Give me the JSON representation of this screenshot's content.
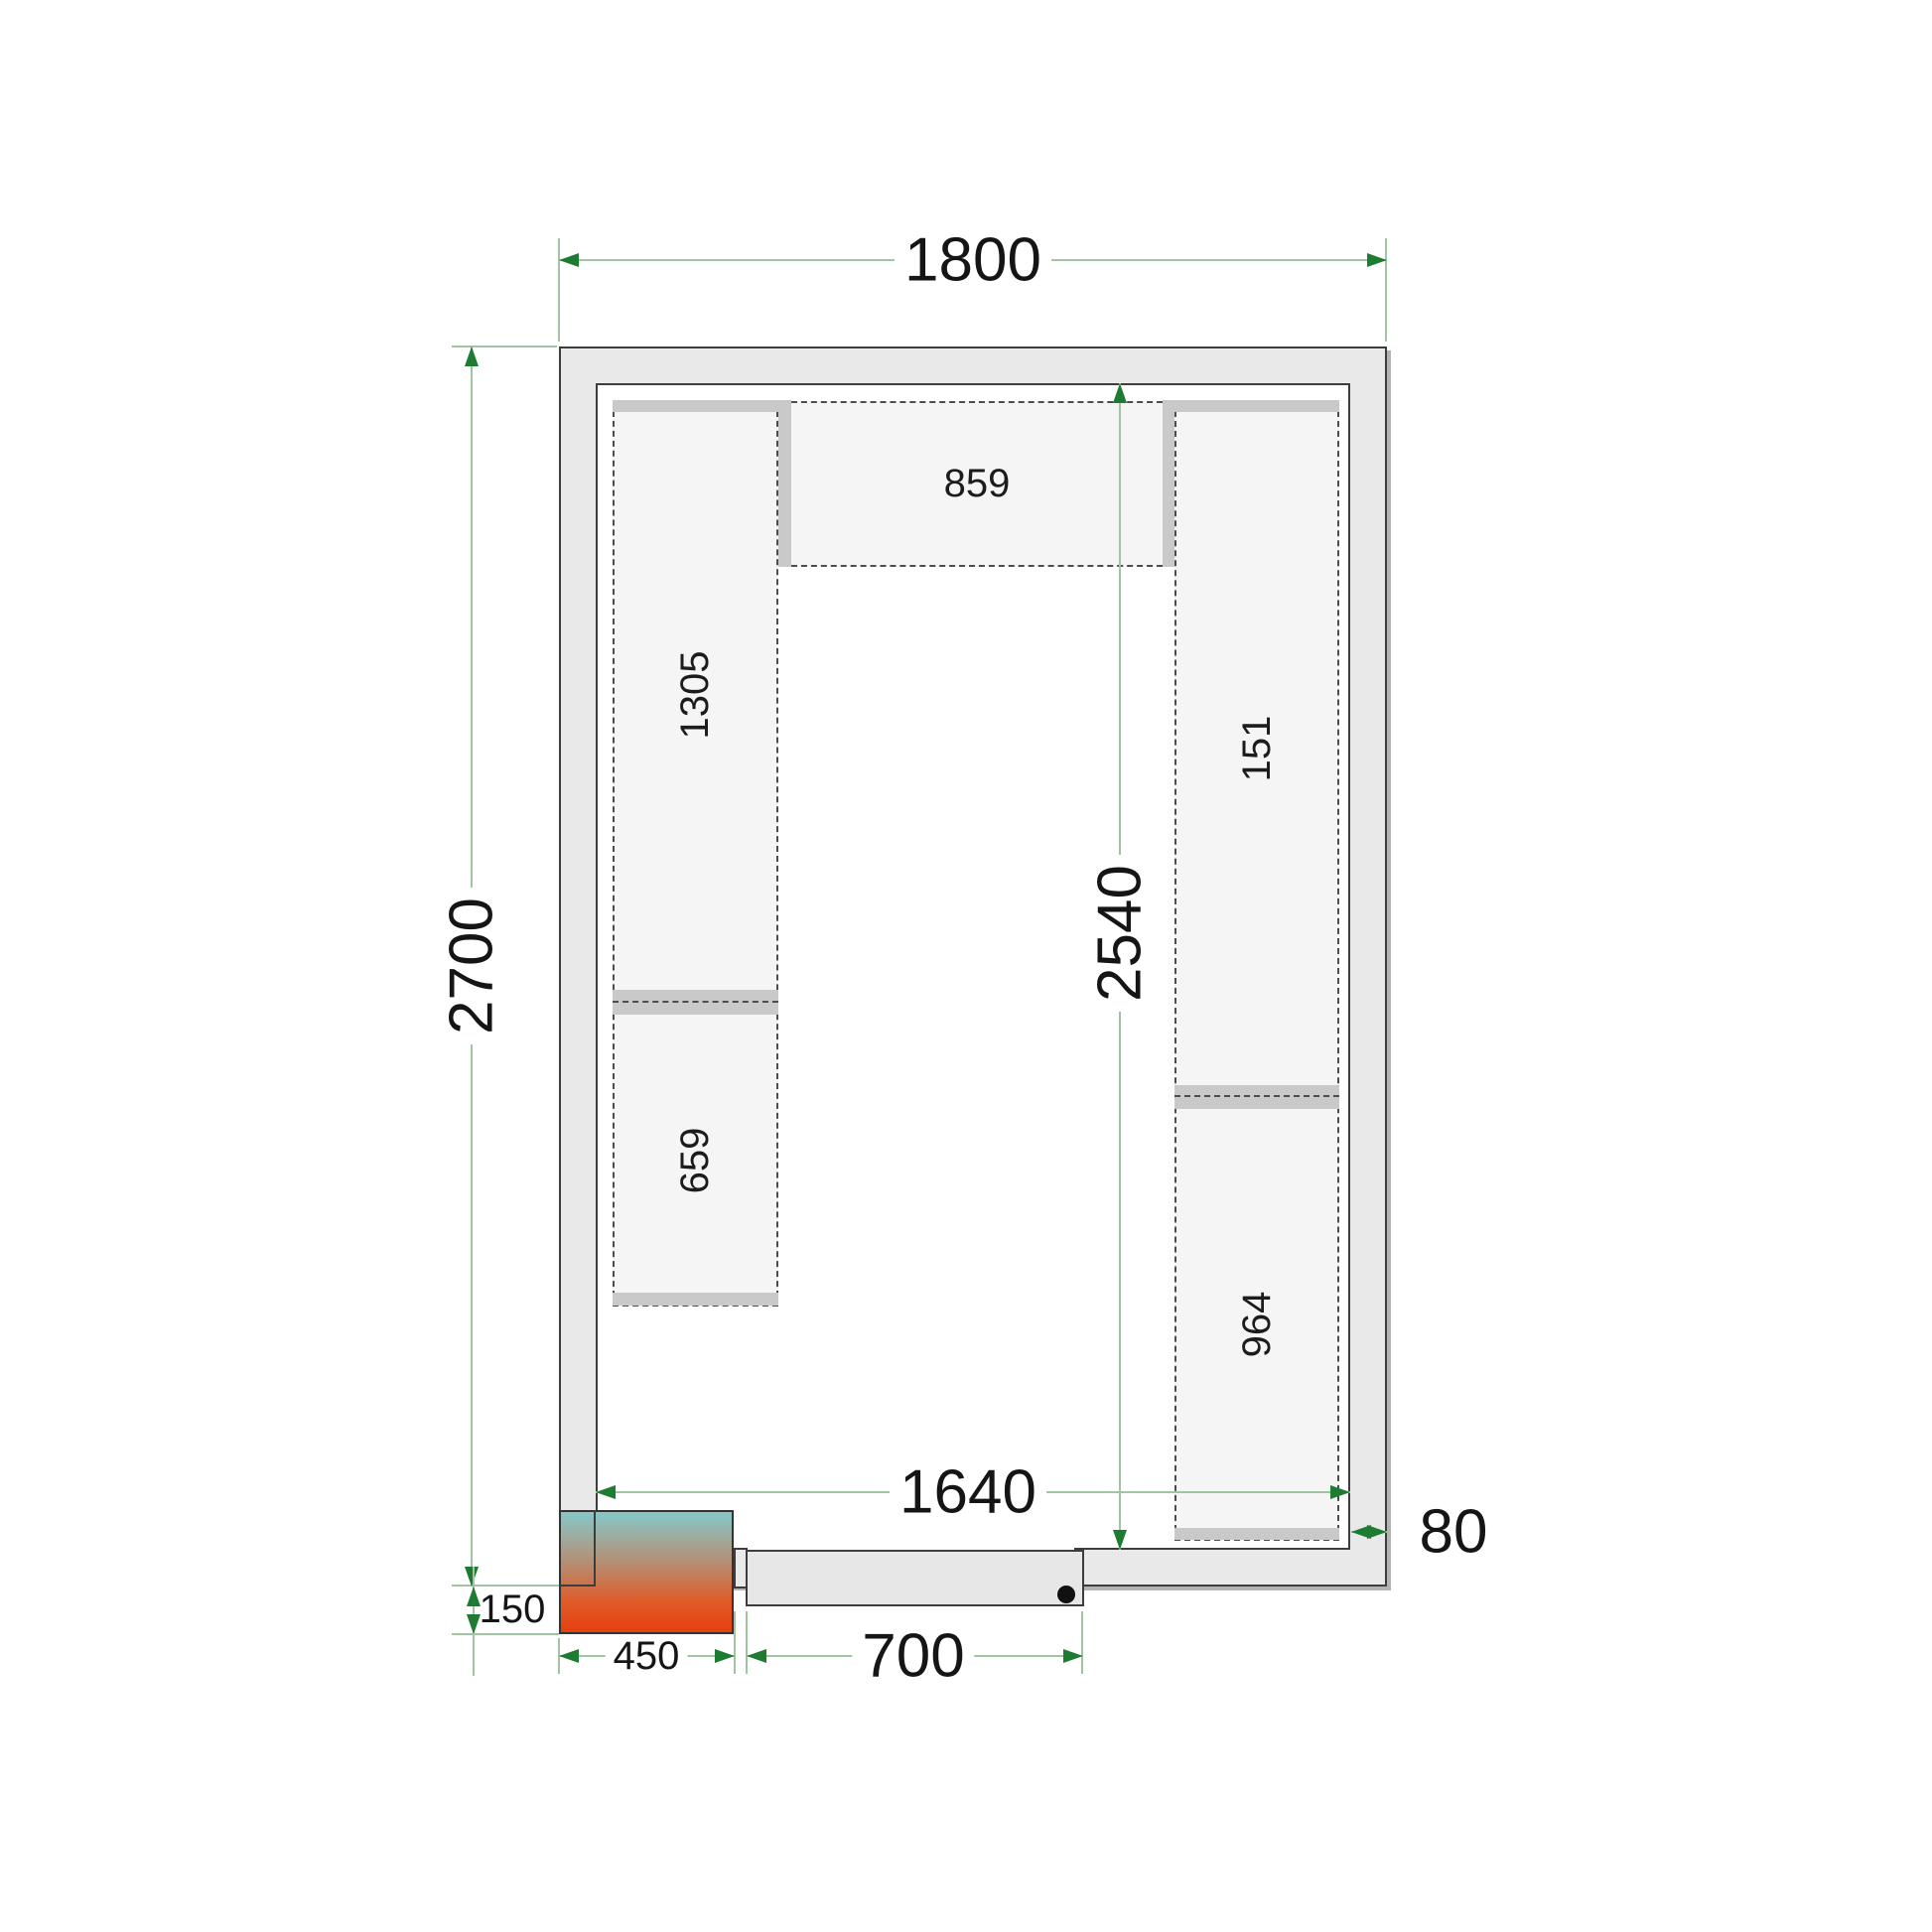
{
  "dimensions": {
    "outer_width": "1800",
    "outer_height": "2700",
    "inner_width": "1640",
    "inner_height": "2540",
    "wall_thickness": "80",
    "cooling_unit_protrusion": "150",
    "cooling_unit_width": "450",
    "door_width": "700"
  },
  "shelf_labels": {
    "top": "859",
    "left_upper": "1305",
    "left_lower": "659",
    "right_upper": "151",
    "right_lower": "964"
  },
  "colors": {
    "wall_fill": "#e9e9e9",
    "shelf_fill": "#f5f5f5",
    "shelf_bar": "#c9c9c9",
    "outline": "#3d3d3d",
    "dashed_outline": "#4d4d4d",
    "dimension_line": "#a3c4a3",
    "dimension_arrow": "#1e7b32",
    "unit_gradient_top": "#85c8c9",
    "unit_gradient_bottom": "#e6400f"
  }
}
